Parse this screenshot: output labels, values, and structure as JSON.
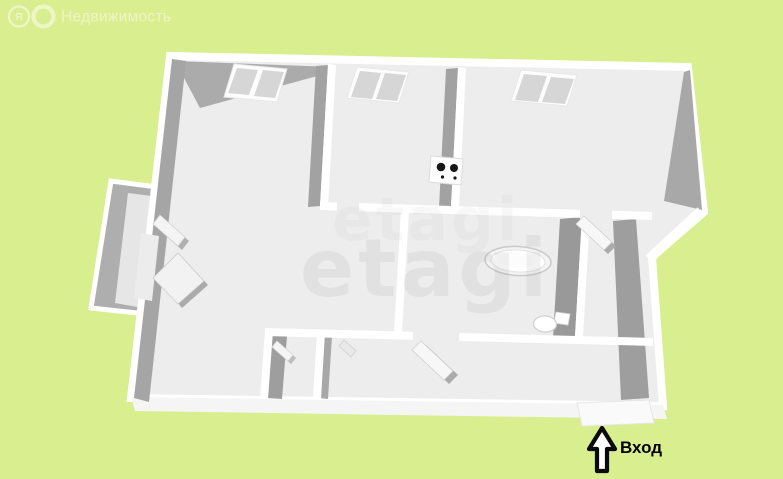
{
  "header": {
    "logo": {
      "letter": "Я",
      "text": "Недвижимость"
    }
  },
  "watermark": {
    "text": "etagi"
  },
  "entrance": {
    "label": "Вход"
  },
  "floor_plan": {
    "icons": [
      "window-icon",
      "window-icon",
      "window-icon",
      "stove-icon",
      "bathtub-icon",
      "toilet-icon",
      "door-leaf-icon",
      "balcony-door-icon",
      "arrow-up-icon"
    ],
    "window_count": 3
  },
  "colors": {
    "background": "#d9ee8e",
    "floor": "#ededed",
    "wall": "#ffffff",
    "wall_shadow": "#a3a3a3",
    "window_pane": "#d6d6d6",
    "entrance_text": "#000000",
    "logo": "#ffffff"
  }
}
